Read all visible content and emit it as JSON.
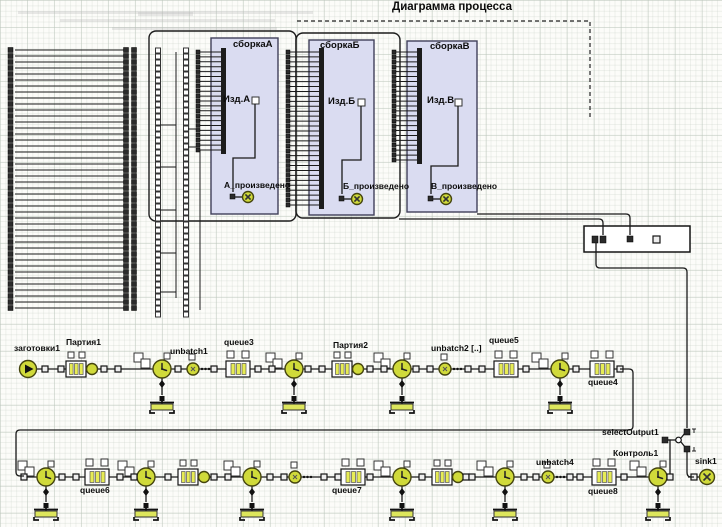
{
  "title": "Диаграмма процесса",
  "assemblies": [
    {
      "title": "сборкаА",
      "product": "Изд.А",
      "produced_label": "А_произведено"
    },
    {
      "title": "сборкаБ",
      "product": "Изд.Б",
      "produced_label": "Б_произведено"
    },
    {
      "title": "сборкаВ",
      "product": "Изд.В",
      "produced_label": "В_произведено"
    }
  ],
  "row1": {
    "source": "заготовки1",
    "batch_a": "Партия1",
    "unbatch1": "unbatch1",
    "queue3": "queue3",
    "batch_b": "Партия2",
    "unbatch2": "unbatch2 [..]",
    "queue5": "queue5",
    "queue4": "queue4"
  },
  "row2": {
    "queue6": "queue6",
    "queue7": "queue7",
    "unbatch4": "unbatch4",
    "queue8": "queue8",
    "control": "Контроль1",
    "select_output": "selectOutput1",
    "sink": "sink1"
  },
  "colors": {
    "block_fill": "#dadcf1",
    "accent_yellow": "#d0da3a",
    "bar_yellow": "#e7ec55",
    "pool_yellow": "#dde65c",
    "wire": "#1a1a1a"
  }
}
